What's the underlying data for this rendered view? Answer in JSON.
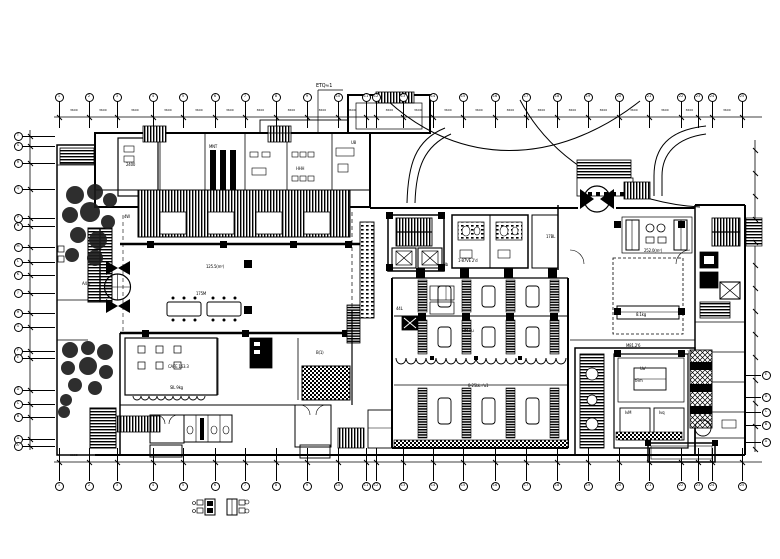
{
  "drawing": {
    "kind": "architectural-floor-plan",
    "grid": {
      "dim_label": "3600",
      "cols": [
        {
          "x": 59,
          "n": "1"
        },
        {
          "x": 89,
          "n": "2"
        },
        {
          "x": 117,
          "n": "3"
        },
        {
          "x": 153,
          "n": "4"
        },
        {
          "x": 183,
          "n": "5"
        },
        {
          "x": 215,
          "n": "6"
        },
        {
          "x": 245,
          "n": "7"
        },
        {
          "x": 276,
          "n": "8"
        },
        {
          "x": 307,
          "n": "9"
        },
        {
          "x": 338,
          "n": "10"
        },
        {
          "x": 366,
          "n": "11"
        },
        {
          "x": 376,
          "n": "12"
        },
        {
          "x": 403,
          "n": "13"
        },
        {
          "x": 433,
          "n": "14"
        },
        {
          "x": 463,
          "n": "15"
        },
        {
          "x": 495,
          "n": "16"
        },
        {
          "x": 526,
          "n": "17"
        },
        {
          "x": 557,
          "n": "18"
        },
        {
          "x": 588,
          "n": "19"
        },
        {
          "x": 619,
          "n": "20"
        },
        {
          "x": 649,
          "n": "21"
        },
        {
          "x": 681,
          "n": "22"
        },
        {
          "x": 698,
          "n": "23"
        },
        {
          "x": 712,
          "n": "24"
        },
        {
          "x": 742,
          "n": "25"
        }
      ],
      "rows_left": [
        {
          "y": 136,
          "n": "T"
        },
        {
          "y": 146,
          "n": "S"
        },
        {
          "y": 163,
          "n": "R"
        },
        {
          "y": 189,
          "n": "Q"
        },
        {
          "y": 218,
          "n": "P"
        },
        {
          "y": 226,
          "n": "N"
        },
        {
          "y": 247,
          "n": "M"
        },
        {
          "y": 262,
          "n": "L"
        },
        {
          "y": 275,
          "n": "K"
        },
        {
          "y": 293,
          "n": "J"
        },
        {
          "y": 313,
          "n": "H"
        },
        {
          "y": 327,
          "n": "G"
        },
        {
          "y": 351,
          "n": "F"
        },
        {
          "y": 358,
          "n": "E"
        },
        {
          "y": 390,
          "n": "D"
        },
        {
          "y": 404,
          "n": "C"
        },
        {
          "y": 417,
          "n": "B"
        },
        {
          "y": 439,
          "n": "A"
        },
        {
          "y": 446,
          "n": "A'"
        }
      ],
      "rows_right": [
        {
          "y": 375,
          "n": "E"
        },
        {
          "y": 397,
          "n": "D"
        },
        {
          "y": 412,
          "n": "C"
        },
        {
          "y": 425,
          "n": "B"
        },
        {
          "y": 442,
          "n": "A"
        }
      ],
      "right_ticks": [
        150,
        173,
        196,
        219,
        242,
        265,
        288,
        311,
        334,
        357,
        380,
        403,
        426,
        449
      ],
      "top": {
        "bubble_y": 97,
        "dim_y": 117,
        "stem_y1": 101,
        "stem_y2": 128
      },
      "bottom": {
        "bubble_y": 486,
        "dim_y": 462,
        "stem_y1": 448,
        "stem_y2": 481
      },
      "left": {
        "bubble_x": 18,
        "dim_x": 30,
        "stem_x1": 22,
        "stem_x2": 55
      },
      "right": {
        "bubble_x": 766,
        "dim_x": 755,
        "stem_x1": 745,
        "stem_x2": 761
      }
    },
    "labels": [
      {
        "t": "ETQ≈1",
        "x": 316,
        "y": 83,
        "s": 5
      },
      {
        "t": "2400",
        "x": 126,
        "y": 162,
        "s": 4
      },
      {
        "t": "MNT",
        "x": 209,
        "y": 144,
        "s": 4
      },
      {
        "t": "HHH",
        "x": 296,
        "y": 166,
        "s": 4
      },
      {
        "t": "U8",
        "x": 351,
        "y": 140,
        "s": 4
      },
      {
        "t": "4W",
        "x": 124,
        "y": 214,
        "s": 4
      },
      {
        "t": "125.5(m²)",
        "x": 206,
        "y": 264,
        "s": 4
      },
      {
        "t": "175M",
        "x": 196,
        "y": 291,
        "s": 4
      },
      {
        "t": "A4 b",
        "x": 82,
        "y": 281,
        "s": 4
      },
      {
        "t": "CAFE 163.3",
        "x": 168,
        "y": 364,
        "s": 4
      },
      {
        "t": "SIL 9kg",
        "x": 170,
        "y": 385,
        "s": 4
      },
      {
        "t": "B(1)",
        "x": 316,
        "y": 350,
        "s": 4
      },
      {
        "t": "44L",
        "x": 396,
        "y": 306,
        "s": 4
      },
      {
        "t": "Hb",
        "x": 443,
        "y": 262,
        "s": 4
      },
      {
        "t": "17BL",
        "x": 546,
        "y": 234,
        "s": 4
      },
      {
        "t": "1-87VE 2'd",
        "x": 458,
        "y": 258,
        "s": 4
      },
      {
        "t": "HM r'u",
        "x": 462,
        "y": 328,
        "s": 4
      },
      {
        "t": "8-25bL r'u1",
        "x": 468,
        "y": 383,
        "s": 4
      },
      {
        "t": "252.0(m²)",
        "x": 644,
        "y": 248,
        "s": 4
      },
      {
        "t": "8.1kg",
        "x": 636,
        "y": 312,
        "s": 4
      },
      {
        "t": "M81.2'6",
        "x": 626,
        "y": 343,
        "s": 4
      },
      {
        "t": "Ua'",
        "x": 640,
        "y": 366,
        "s": 4
      },
      {
        "t": "tFim",
        "x": 635,
        "y": 378,
        "s": 4
      },
      {
        "t": "IvM",
        "x": 625,
        "y": 410,
        "s": 4
      },
      {
        "t": "Ivq",
        "x": 659,
        "y": 410,
        "s": 4
      },
      {
        "t": "1u'",
        "x": 687,
        "y": 350,
        "s": 4
      },
      {
        "t": "k4d",
        "x": 699,
        "y": 388,
        "s": 4
      }
    ]
  }
}
